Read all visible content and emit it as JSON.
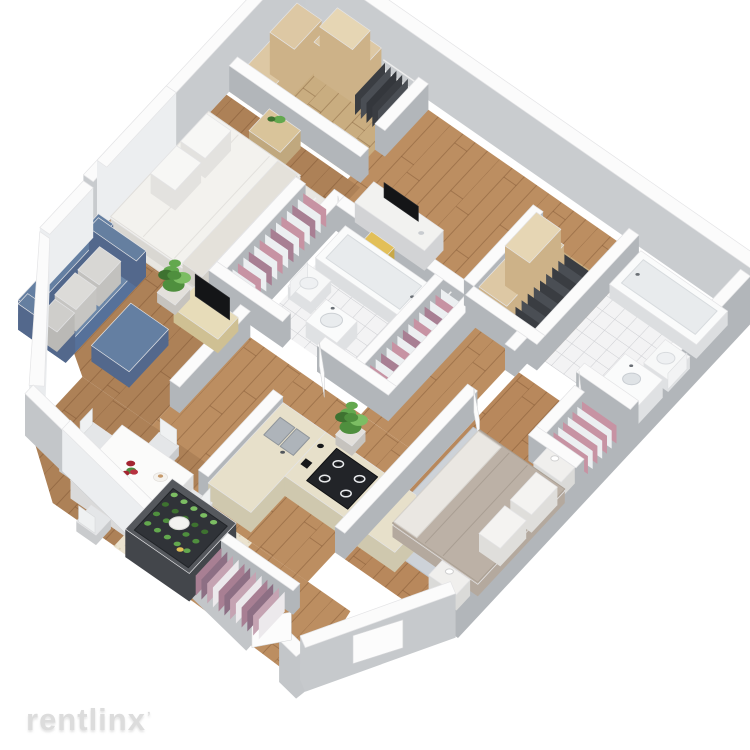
{
  "image_type": "3d-isometric-apartment-floor-plan-render",
  "watermark": {
    "text": "rentlinx",
    "mark": "ʼ"
  },
  "palette": {
    "background": "#ffffff",
    "wall_top": "#fbfbfb",
    "wall_edge": "#e4e4e6",
    "wall_side": "#b2b6ba",
    "wall_side_light": "#c8cbce",
    "window_white": "#eceef0",
    "wood_hall": "#bc8e61",
    "wood_living": "#ad8157",
    "wood_bedroom2": "#b8885c",
    "wood_closet": "#c9ad80",
    "wood_line": "rgba(96,56,28,0.30)",
    "tile_floor": "#f3f3f4",
    "tile_line": "#cdced2",
    "cream_tile": "#ebe3cf",
    "cream_dot": "#dbd0b4",
    "rug_light": "#e8e6e1",
    "rug_blue_gray": "#cdd2d8",
    "sofa_blue": "#6d88a9",
    "sofa_blue_dark": "#56719a",
    "ottoman_blue": "#647fa2",
    "pillow_gray": "#d8d7d4",
    "bed_white": "#f3f2ee",
    "bed2_duvet": "#bcb1a6",
    "bed2_side": "#b4a99e",
    "throw_white": "#eae7e2",
    "wood_furniture": "#d9c49a",
    "wood_furniture_side": "#c0a87e",
    "console_wood": "#e7dcb9",
    "tv_black": "#141517",
    "counter_top": "#e7e0ca",
    "counter_side": "#cfc8ae",
    "stove_black": "#222428",
    "sink_steel": "#aeb4ba",
    "chair_yellow": "#e2bf58",
    "chair_yellow_dark": "#c9a847",
    "chair_white": "#e4e6e8",
    "plant_greens": [
      "#4f8f3e",
      "#63a84e",
      "#7cbd63",
      "#3e7230"
    ],
    "clothes_pink": "#c793a3",
    "clothes_white": "#eceff1",
    "clothes_mauve": "#a87f93",
    "clothes_mauve_dark": "#8d6f84",
    "clothes_dark": "#3a3d42",
    "shelf_beige": "#cdb288",
    "shelf_beige_light": "#ddc8a4",
    "pantry_frame": "#43464b",
    "flower_red": "#a32431",
    "flower_red2": "#b63240",
    "fixture_white": "#fafbfb",
    "fixture_inner": "#e8ebed",
    "watermark_color": "#dcdcdc"
  },
  "apartment": {
    "style": "white-walls, gray wall sides, isometric top-down view",
    "rooms": [
      {
        "name": "walk-in-closet",
        "furniture": [
          "shelving-stacks",
          "dark-hanging-clothes"
        ]
      },
      {
        "name": "master-bedroom",
        "furniture": [
          "double-bed-white",
          "nightstand-with-plant",
          "area-rug"
        ]
      },
      {
        "name": "bathroom-1",
        "furniture": [
          "bathtub",
          "toilet",
          "oval-sink",
          "tiled-floor"
        ]
      },
      {
        "name": "desk-nook",
        "furniture": [
          "desk",
          "monitor",
          "yellow-chair"
        ]
      },
      {
        "name": "hallway",
        "furniture": []
      },
      {
        "name": "closets",
        "furniture": [
          "pink-white-hanging-clothes",
          "mauve-hanging-clothes",
          "linen-shelves",
          "shoe-rack"
        ]
      },
      {
        "name": "bathroom-2",
        "furniture": [
          "bathtub",
          "toilet",
          "vanity-sink",
          "tiled-floor"
        ]
      },
      {
        "name": "living-room",
        "furniture": [
          "blue-sofa",
          "gray-pillows",
          "blue-ottoman",
          "tv-console",
          "flat-tv",
          "potted-plant",
          "window-wall"
        ]
      },
      {
        "name": "kitchen",
        "furniture": [
          "l-shaped-counter",
          "double-sink",
          "gas-cooktop-4-burner",
          "small-appliances",
          "potted-plant"
        ]
      },
      {
        "name": "dining-area",
        "furniture": [
          "white-table",
          "six-chairs",
          "red-flower-centerpiece",
          "place-settings"
        ]
      },
      {
        "name": "pantry",
        "furniture": [
          "dark-frame-shelves",
          "green-plants",
          "round-white-table",
          "yellow-stool"
        ]
      },
      {
        "name": "entry",
        "furniture": [
          "coat-closet-mauve-clothes",
          "open-doors"
        ]
      },
      {
        "name": "bedroom-2",
        "furniture": [
          "double-bed-gray",
          "white-pillows",
          "two-nightstands",
          "blue-gray-rug",
          "pink-clothes-closet"
        ]
      }
    ]
  }
}
